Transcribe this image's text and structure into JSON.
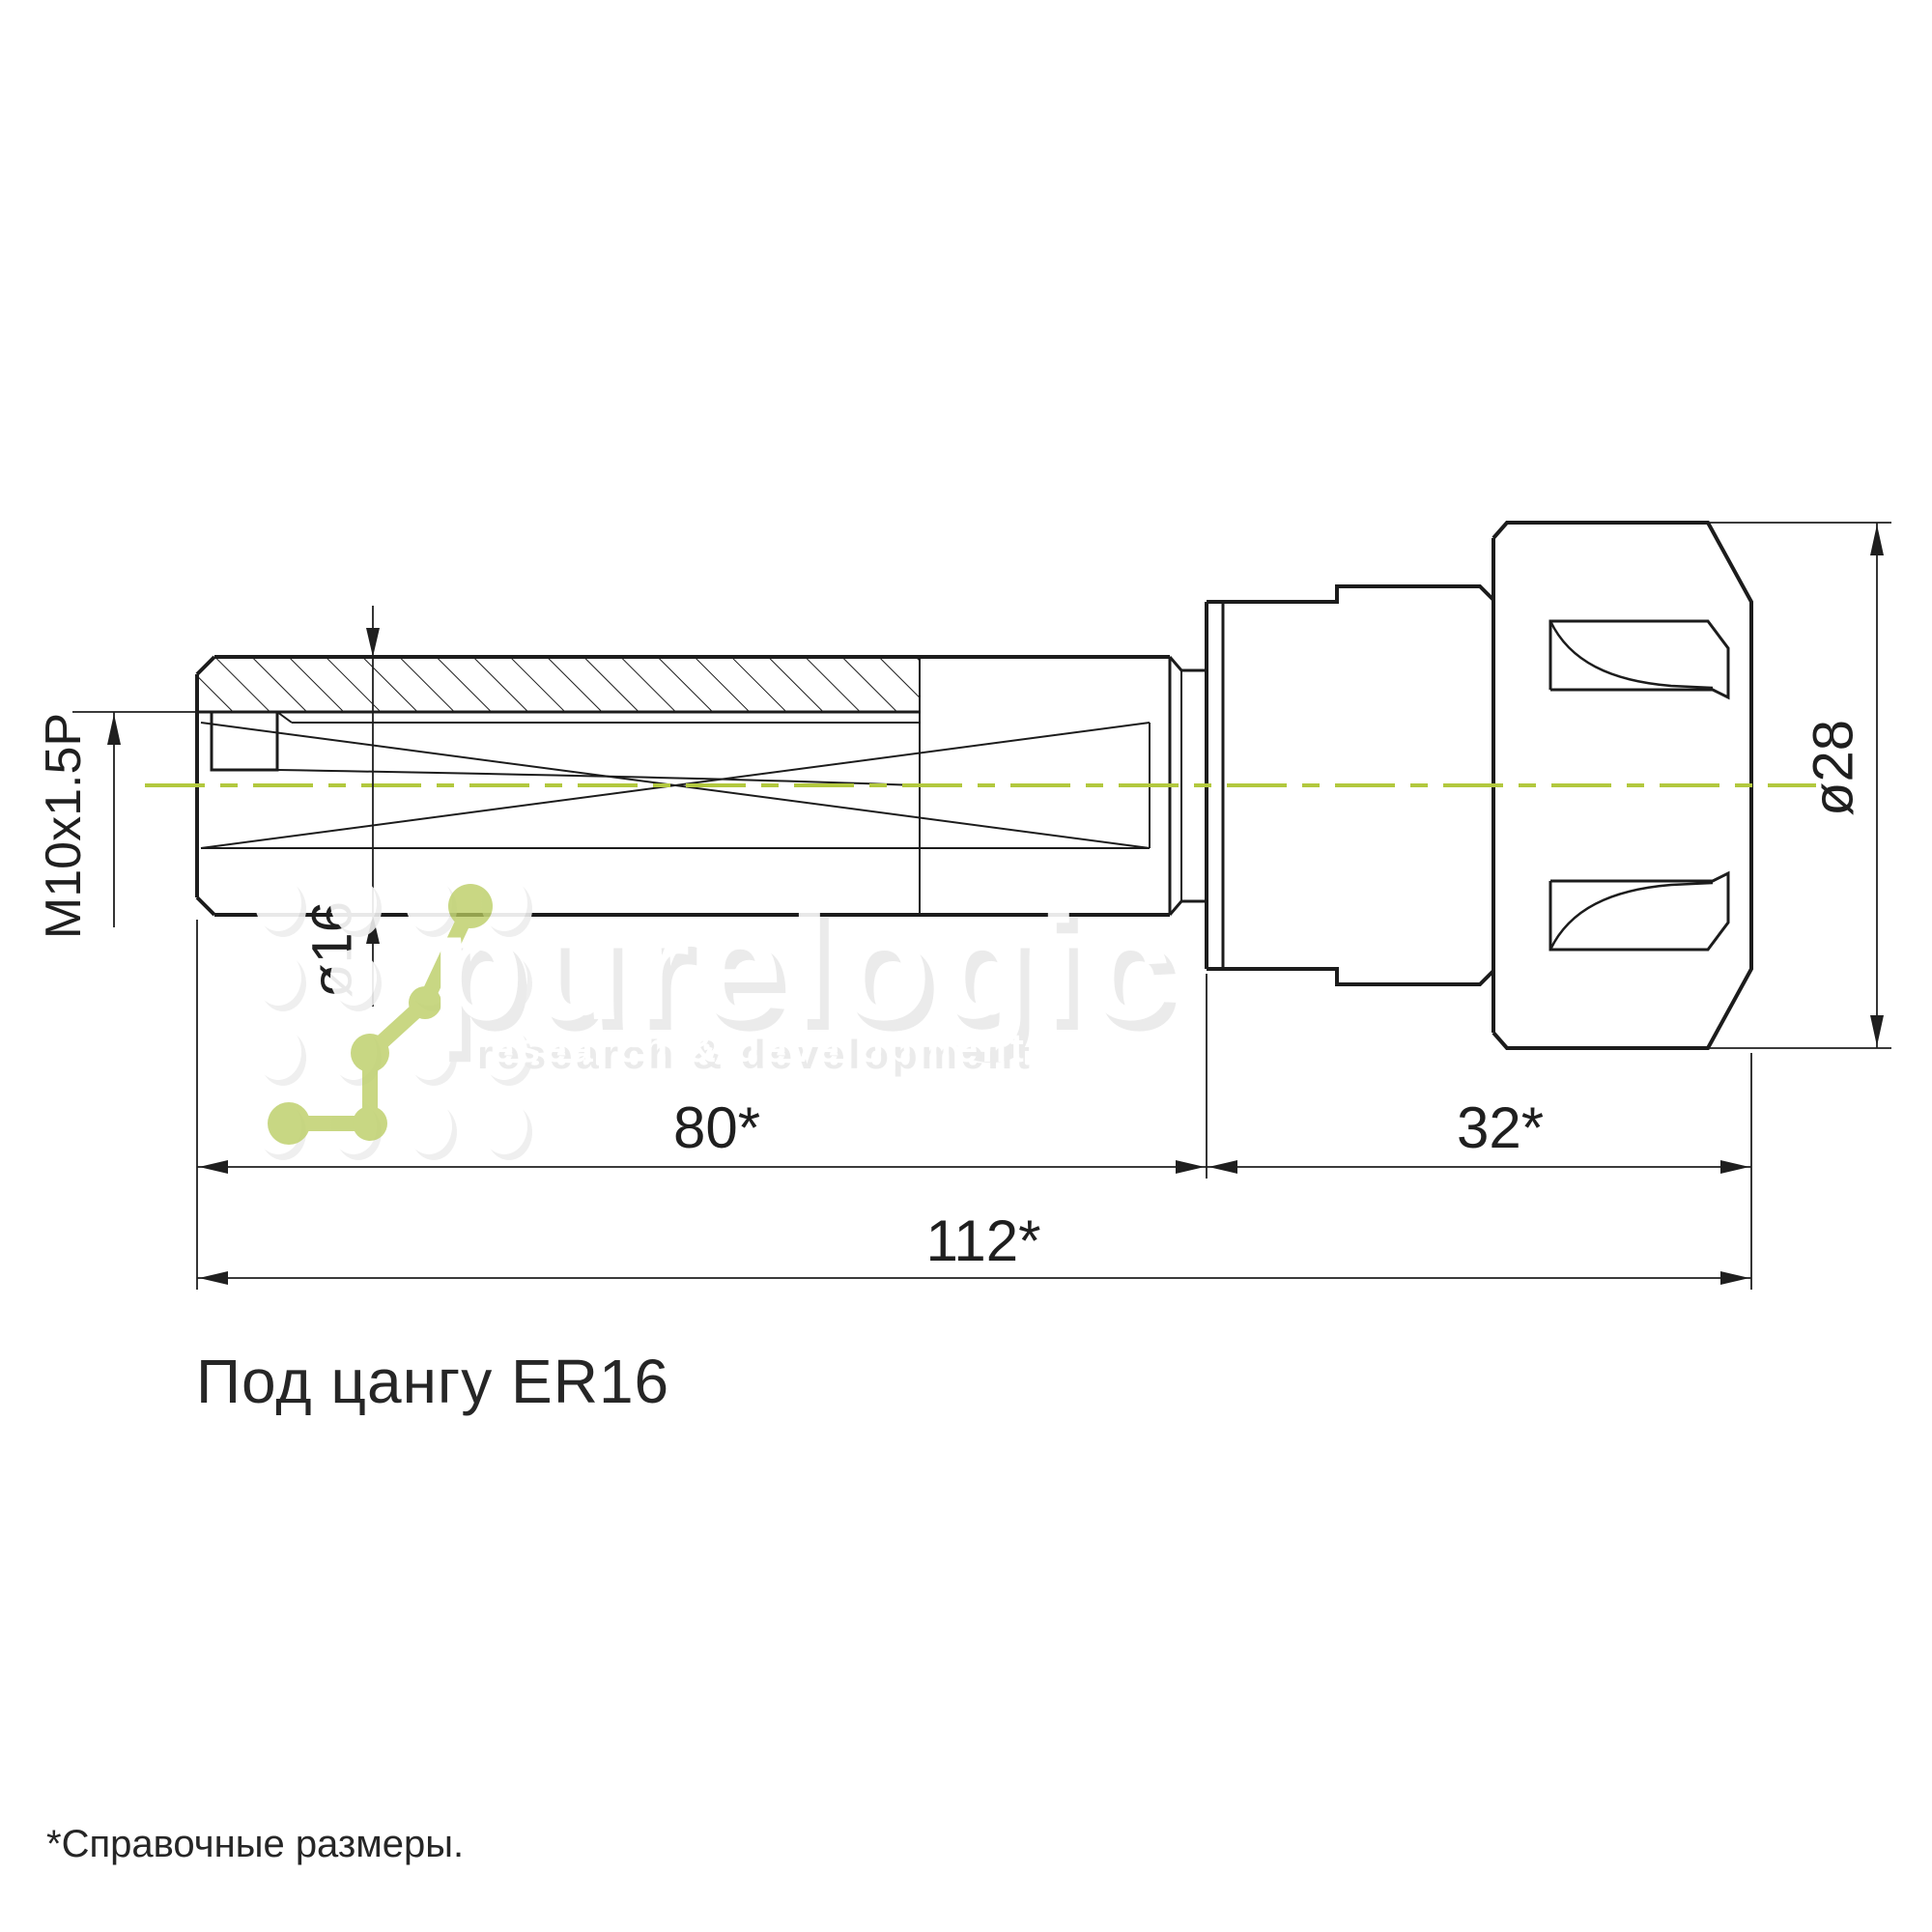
{
  "drawing": {
    "title": "Под цангу ER16",
    "footnote": "*Справочные размеры.",
    "dimensions": {
      "thread": "M10x1.5P",
      "shank_diameter": "ø16",
      "nut_diameter": "ø28",
      "shank_length": "80*",
      "nut_length": "32*",
      "total_length": "112*"
    },
    "colors": {
      "line": "#1c1c1c",
      "centerline": "#b2c83e",
      "watermark_green": "#b9cc5f"
    }
  },
  "watermark": {
    "brand": "purelogic",
    "tagline": "research & development"
  }
}
